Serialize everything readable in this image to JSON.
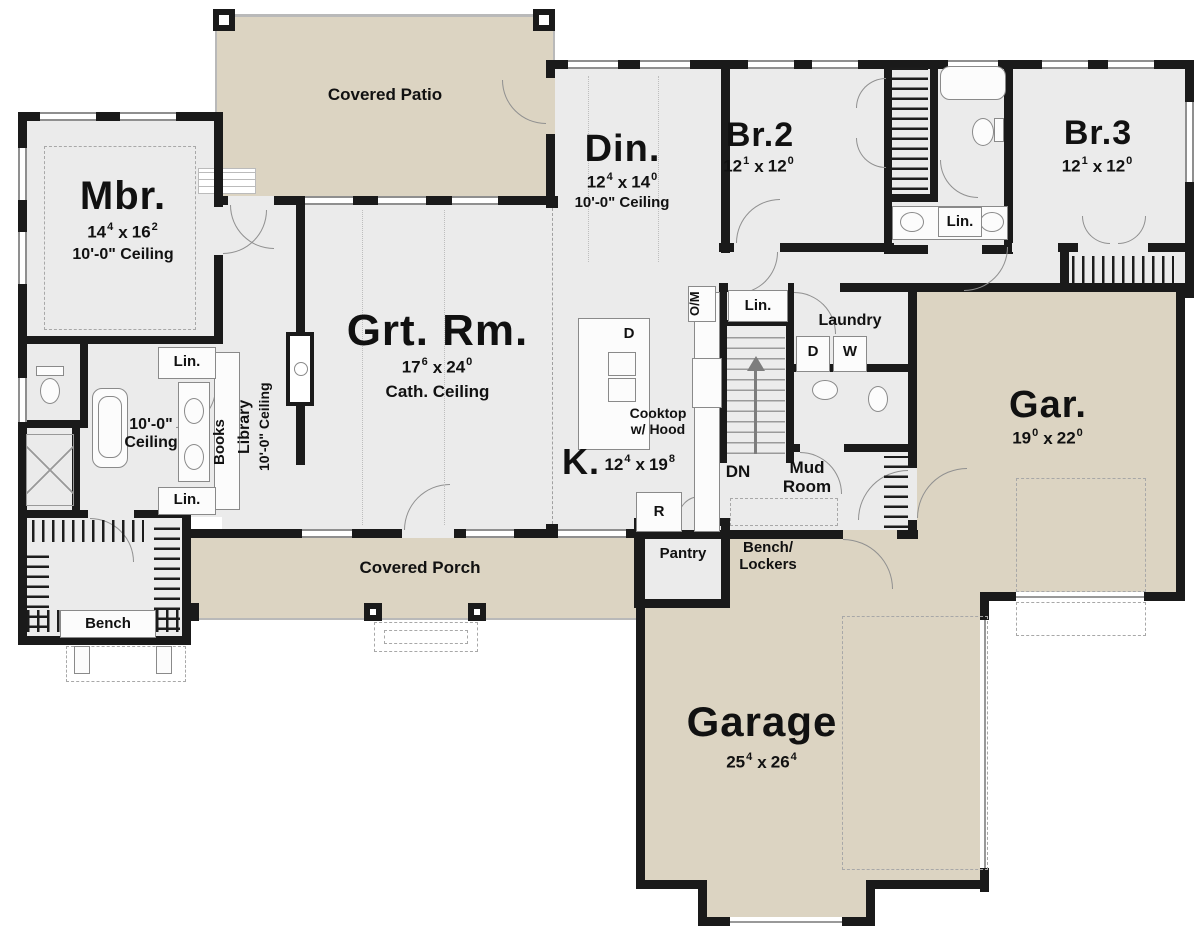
{
  "labels": {
    "x": "x",
    "lin": "Lin.",
    "books": "Books",
    "library": "Library",
    "ceiling10": "10'-0\" Ceiling",
    "ceiling10a": "10'-0\"",
    "ceiling10b": "Ceiling",
    "cath": "Cath. Ceiling",
    "covered_patio": "Covered Patio",
    "covered_porch": "Covered Porch",
    "dn": "DN",
    "laundry": "Laundry",
    "mud1": "Mud",
    "mud2": "Room",
    "pantry": "Pantry",
    "bench": "Bench",
    "bench1": "Bench/",
    "bench2": "Lockers",
    "cooktop1": "Cooktop",
    "cooktop2": "w/ Hood",
    "dryer": "D",
    "washer": "W",
    "fridge": "R",
    "om": "O/M",
    "island_d": "D"
  },
  "rooms": {
    "mbr": {
      "name": "Mbr.",
      "dims": [
        "14",
        "4",
        "16",
        "2"
      ],
      "ceiling": "10'-0\" Ceiling"
    },
    "grt": {
      "name": "Grt. Rm.",
      "dims": [
        "17",
        "6",
        "24",
        "0"
      ],
      "ceiling": "Cath. Ceiling"
    },
    "din": {
      "name": "Din.",
      "dims": [
        "12",
        "4",
        "14",
        "0"
      ],
      "ceiling": "10'-0\" Ceiling"
    },
    "br2": {
      "name": "Br.2",
      "dims": [
        "12",
        "1",
        "12",
        "0"
      ]
    },
    "br3": {
      "name": "Br.3",
      "dims": [
        "12",
        "1",
        "12",
        "0"
      ]
    },
    "kitchen": {
      "name": "K.",
      "dims": [
        "12",
        "4",
        "19",
        "8"
      ]
    },
    "gar": {
      "name": "Gar.",
      "dims": [
        "19",
        "0",
        "22",
        "0"
      ]
    },
    "garage": {
      "name": "Garage",
      "dims": [
        "25",
        "4",
        "26",
        "4"
      ]
    },
    "mbath": {
      "ceiling_1": "10'-0\"",
      "ceiling_2": "Ceiling"
    }
  },
  "colors": {
    "outdoor": "#dcd4c2",
    "interior": "#ebebeb",
    "wall": "#1a1a1a"
  }
}
